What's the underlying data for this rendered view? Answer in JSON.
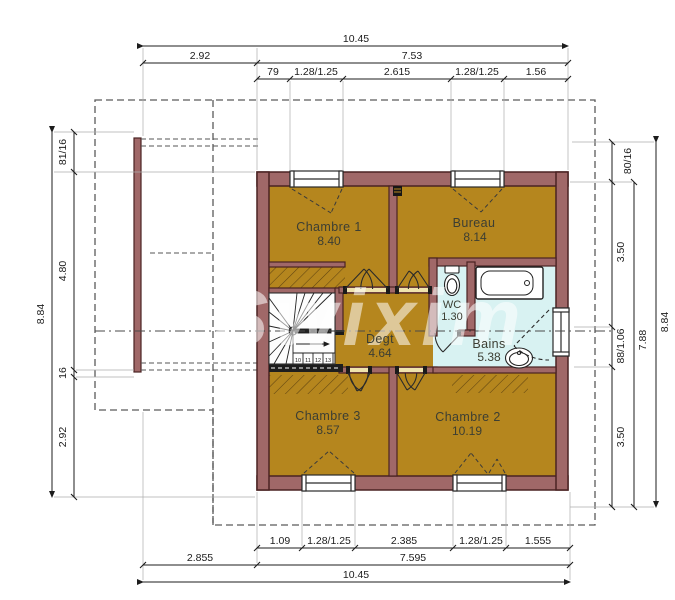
{
  "watermark": "Swixim",
  "plan": {
    "rooms": [
      {
        "name": "Chambre 1",
        "area": "8.40"
      },
      {
        "name": "Bureau",
        "area": "8.14"
      },
      {
        "name": "WC",
        "area": "1.30"
      },
      {
        "name": "Degt",
        "area": "4.64"
      },
      {
        "name": "Bains",
        "area": "5.38"
      },
      {
        "name": "Chambre 3",
        "area": "8.57"
      },
      {
        "name": "Chambre 2",
        "area": "10.19"
      }
    ],
    "stair_steps": [
      "10",
      "11",
      "12",
      "13"
    ]
  },
  "dimensions": {
    "top": {
      "total": "10.45",
      "row2": [
        "2.92",
        "7.53"
      ],
      "row3": [
        "79",
        "1.28/1.25",
        "2.615",
        "1.28/1.25",
        "1.56"
      ]
    },
    "bottom": {
      "row1": [
        "1.09",
        "1.28/1.25",
        "2.385",
        "1.28/1.25",
        "1.555"
      ],
      "row2": [
        "2.855",
        "7.595"
      ],
      "total": "10.45"
    },
    "left": {
      "total": "8.84",
      "chain": [
        "81/16",
        "4.80",
        "16",
        "2.92"
      ]
    },
    "right": {
      "total": "8.84",
      "sub": "7.88",
      "chain": [
        "80/16",
        "3.50",
        "88/1.06",
        "3.50"
      ]
    }
  },
  "colors": {
    "floor": "#b5861e",
    "wall_fill": "#a06868",
    "wall_edge": "#4a2222",
    "bath_floor": "#d8f2f2",
    "opening": "#efe3ad",
    "watermark": "#ffffff"
  }
}
